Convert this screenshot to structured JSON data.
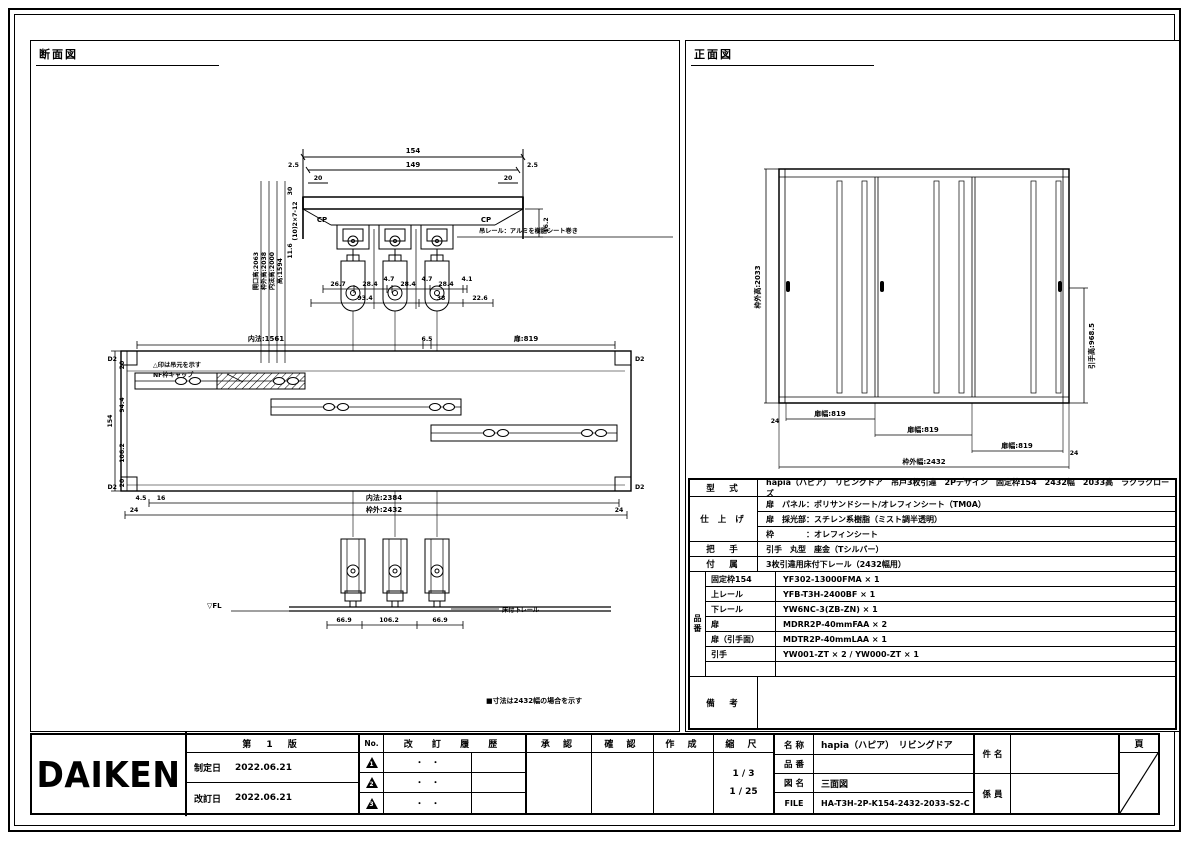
{
  "sheet": {
    "section_label": "断面図",
    "front_label": "正面図"
  },
  "section_view": {
    "top_detail": {
      "dim_154": "154",
      "dim_149": "149",
      "dim_25_l": "2.5",
      "dim_25_r": "2.5",
      "dim_20_l": "20",
      "dim_20_r": "20",
      "cp_l": "CP",
      "cp_r": "CP",
      "dim_162": "16.2",
      "callout_rail": "吊レール：アルミを樹脂シート巻き",
      "dims_row1": [
        "26.7",
        "28.4",
        "4.7",
        "28.4",
        "4.7",
        "28.4",
        "4.1"
      ],
      "dims_row2": [
        "93.4",
        "38",
        "22.6"
      ],
      "left_labels": [
        "開口高:2063",
        "枠外高:2038",
        "内法高:2000",
        "高:1594"
      ],
      "small_labels": [
        "30",
        "(10)2×7-12",
        "11.6"
      ]
    },
    "plan": {
      "corner_tl": "D2",
      "corner_tr": "D2",
      "corner_bl": "D2",
      "corner_br": "D2",
      "dim_uchinori": "内法:1561",
      "dim_65": "6.5",
      "dim_tobira": "扉:819",
      "left_dims": [
        "20",
        "154",
        "94.4",
        "106.2",
        "20"
      ],
      "dim_45": "4.5",
      "dim_16": "16",
      "dim_uchinori2": "内法:2384",
      "dim_wakugai": "枠外:2432",
      "dim_24_l": "24",
      "dim_24_r": "24",
      "note1": "△印は吊元を示す",
      "note2": "NF枠キャップ"
    },
    "bottom_detail": {
      "fl": "▽FL",
      "rail_callout": "床付下レール",
      "dims": [
        "66.9",
        "106.2",
        "66.9"
      ]
    },
    "note": "■寸法は2432幅の場合を示す"
  },
  "front_view": {
    "dim_height": "枠外高:2033",
    "dim_handle_height": "引手高:968.5",
    "door_widths": [
      "扉幅:819",
      "扉幅:819",
      "扉幅:819"
    ],
    "dim_total": "枠外幅:2432",
    "dim_24_l": "24",
    "dim_24_r": "24"
  },
  "spec": {
    "labels": {
      "model": "型　式",
      "finish": "仕 上 げ",
      "handle": "把　手",
      "accessory": "付　属",
      "part_no": "品番",
      "remarks": "備　考"
    },
    "model": "hapia（ハピア）　リビングドア　吊戸3枚引違　2Pデザイン　固定枠154　2432幅　2033高　ラクラクローズ",
    "finish_rows": [
      "扉　パネル：ポリサンドシート/オレフィンシート（TM0A）",
      "扉　採光部：スチレン系樹脂（ミスト調半透明）",
      "枠　　　　：オレフィンシート"
    ],
    "handle": "引手　丸型　座金（Tシルバー）",
    "accessory": "3枚引違用床付下レール（2432幅用）",
    "parts": [
      {
        "name": "固定枠154",
        "no": "YF302-13000FMA × 1"
      },
      {
        "name": "上レール",
        "no": "YFB-T3H-2400BF × 1"
      },
      {
        "name": "下レール",
        "no": "YW6NC-3(ZB-ZN) × 1"
      },
      {
        "name": "扉",
        "no": "MDRR2P-40mmFAA × 2"
      },
      {
        "name": "扉（引手面）",
        "no": "MDTR2P-40mmLAA × 1"
      },
      {
        "name": "引手",
        "no": "YW001-ZT × 2 / YW000-ZT × 1"
      },
      {
        "name": "",
        "no": ""
      }
    ],
    "remarks": ""
  },
  "title_block": {
    "logo": "DAIKEN",
    "edition": "第 1 版",
    "enacted_label": "制定日",
    "enacted_date": "2022.06.21",
    "revised_label": "改訂日",
    "revised_date": "2022.06.21",
    "no_header": "No.",
    "history_header": "改 訂 履 歴",
    "revisions": [
      {
        "mark": "1",
        "date": "・　・"
      },
      {
        "mark": "2",
        "date": "・　・"
      },
      {
        "mark": "3",
        "date": "・　・"
      }
    ],
    "approve": "承 認",
    "check": "確 認",
    "create": "作 成",
    "scale_label": "縮 尺",
    "scale1": "1 / 3",
    "scale2": "1 / 25",
    "name_label": "名 称",
    "name": "hapia（ハピア）　リビングドア",
    "item_label": "品 番",
    "item": "",
    "drawing_label": "図 名",
    "drawing": "三面図",
    "file_label": "FILE",
    "file": "HA-T3H-2P-K154-2432-2033-S2-C",
    "subject_label": "件 名",
    "subject": "",
    "staff_label": "係 員",
    "staff": "",
    "page_label": "頁"
  }
}
